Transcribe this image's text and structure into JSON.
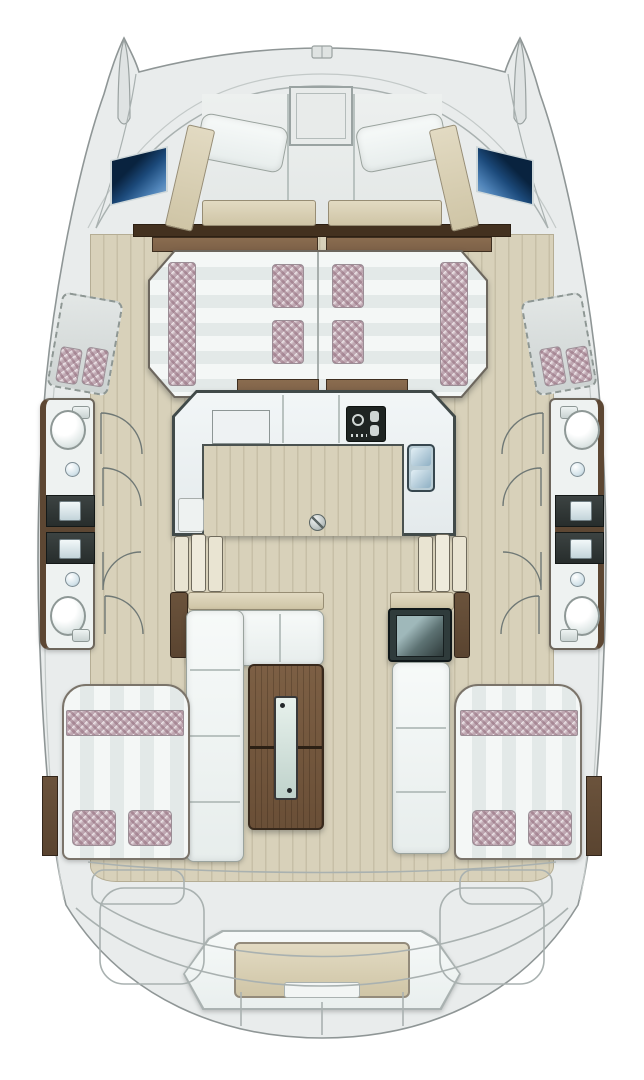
{
  "meta": {
    "diagram": "yacht-floor-plan",
    "vessel": "catamaran",
    "view": "top-down-bow-up"
  },
  "colors": {
    "hull": "#e9ecec",
    "hullLine": "#8f9696",
    "deck": "#e7eae9",
    "deckLine": "#a9b1b0",
    "wood": "#d8d1ba",
    "woodLine": "#cbc3a8",
    "brown": "#7d6148",
    "brownDark": "#43311f",
    "brownDeep": "#5a4430",
    "tan": "#cfc5a6",
    "tanLight": "#e2dac2",
    "cushion": "#f2f5f4",
    "cushionLine": "#9aa39e",
    "stripeA": "#f4f7f6",
    "stripeB": "#e3e9e8",
    "checker": "#926c7c",
    "checkerBg": "#f4eef1",
    "counter": "#323837",
    "floorWhite": "#eef2f1",
    "frame": "#414a49",
    "windowBlue1": "#09233f",
    "windowBlue2": "#8fb4d8",
    "steel": "#8fb0c4",
    "steelLight": "#e2eff5",
    "stove": "#1e2422",
    "glass": "#cfe0da",
    "grillDark": "#2f3b3b",
    "grillGlass": "#9fb8ba"
  },
  "elements": {
    "portBow": "Port bow",
    "starboardBow": "Starboard bow",
    "foredeck": "Foredeck",
    "anchorFitting": "Anchor fitting",
    "forwardCockpit": "Forward cockpit seating",
    "foredeckHatch": "Deck hatch",
    "portWindow": "Port hull window",
    "starboardWindow": "Starboard hull window",
    "forwardLounge": "Forward lounge berth",
    "loungePillow": "Cushion",
    "crewBerthPort": "Port forepeak berth",
    "crewBerthStbd": "Starboard forepeak berth",
    "sideDeckPort": "Port side deck",
    "sideDeckStbd": "Starboard side deck",
    "galley": "Galley",
    "stove": "Stove",
    "galleySink": "Galley sink",
    "counterHatch": "Worktop hatch",
    "galleyCabinet": "Galley cabinet",
    "saloonFloor": "Saloon floor",
    "floorFitting": "Floor fitting",
    "headPortFwd": "Port forward head",
    "headPortAft": "Port aft head",
    "headStbdFwd": "Starboard forward head",
    "headStbdAft": "Starboard aft head",
    "toilet": "Toilet",
    "washbasin": "Washbasin",
    "vanity": "Vanity",
    "stairsPort": "Port companionway steps",
    "stairsStbd": "Starboard companionway steps",
    "doorSwing": "Door swing",
    "cockpit": "Aft cockpit",
    "cockpitTable": "Cockpit table",
    "cockpitSofa": "Cockpit L-sofa",
    "cockpitBench": "Cockpit bench",
    "coolBox": "Cool box",
    "aftCabinPort": "Port aft cabin berth",
    "aftCabinStbd": "Starboard aft cabin berth",
    "pillow": "Pillow",
    "wardrobe": "Wardrobe",
    "transomBench": "Transom bench seat",
    "swimPlatform": "Swim platform",
    "sternSteps": "Stern steps"
  }
}
